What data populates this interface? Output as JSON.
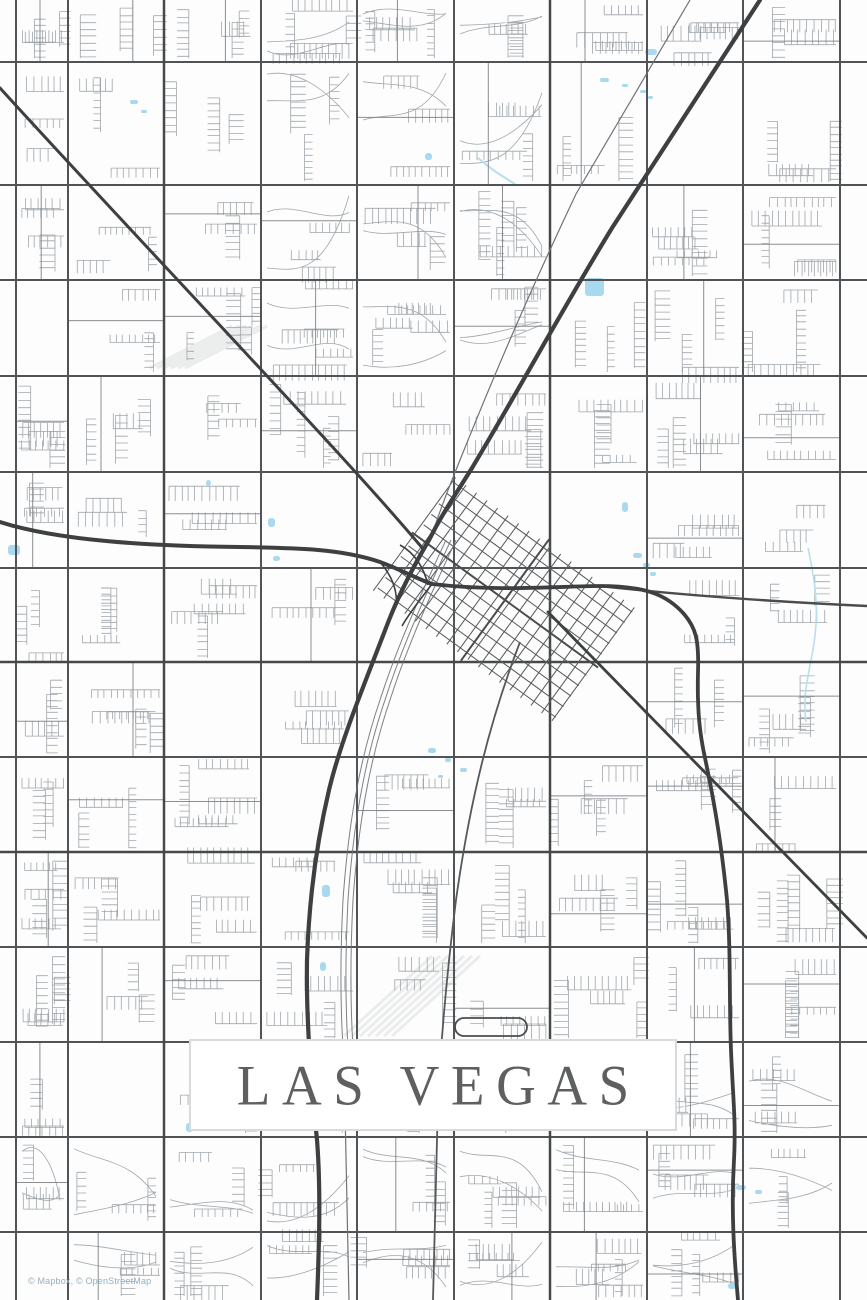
{
  "poster": {
    "title": "LAS VEGAS",
    "attribution": "© Mapbox, © OpenStreetMap"
  },
  "colors": {
    "background": "#fdfdfd",
    "road_major": "#3d3f40",
    "road_arterial": "#515456",
    "road_collector": "#7d8286",
    "road_minor": "#9ba1a6",
    "rail": "#6f7376",
    "water": "#a9d9ee",
    "water_stream": "#b9dff0",
    "hatch": "#ebecec",
    "banner_bg": "#ffffff",
    "banner_border": "#d8dadb",
    "title_text": "#5d5f61",
    "attribution_text": "#93b0bf"
  }
}
